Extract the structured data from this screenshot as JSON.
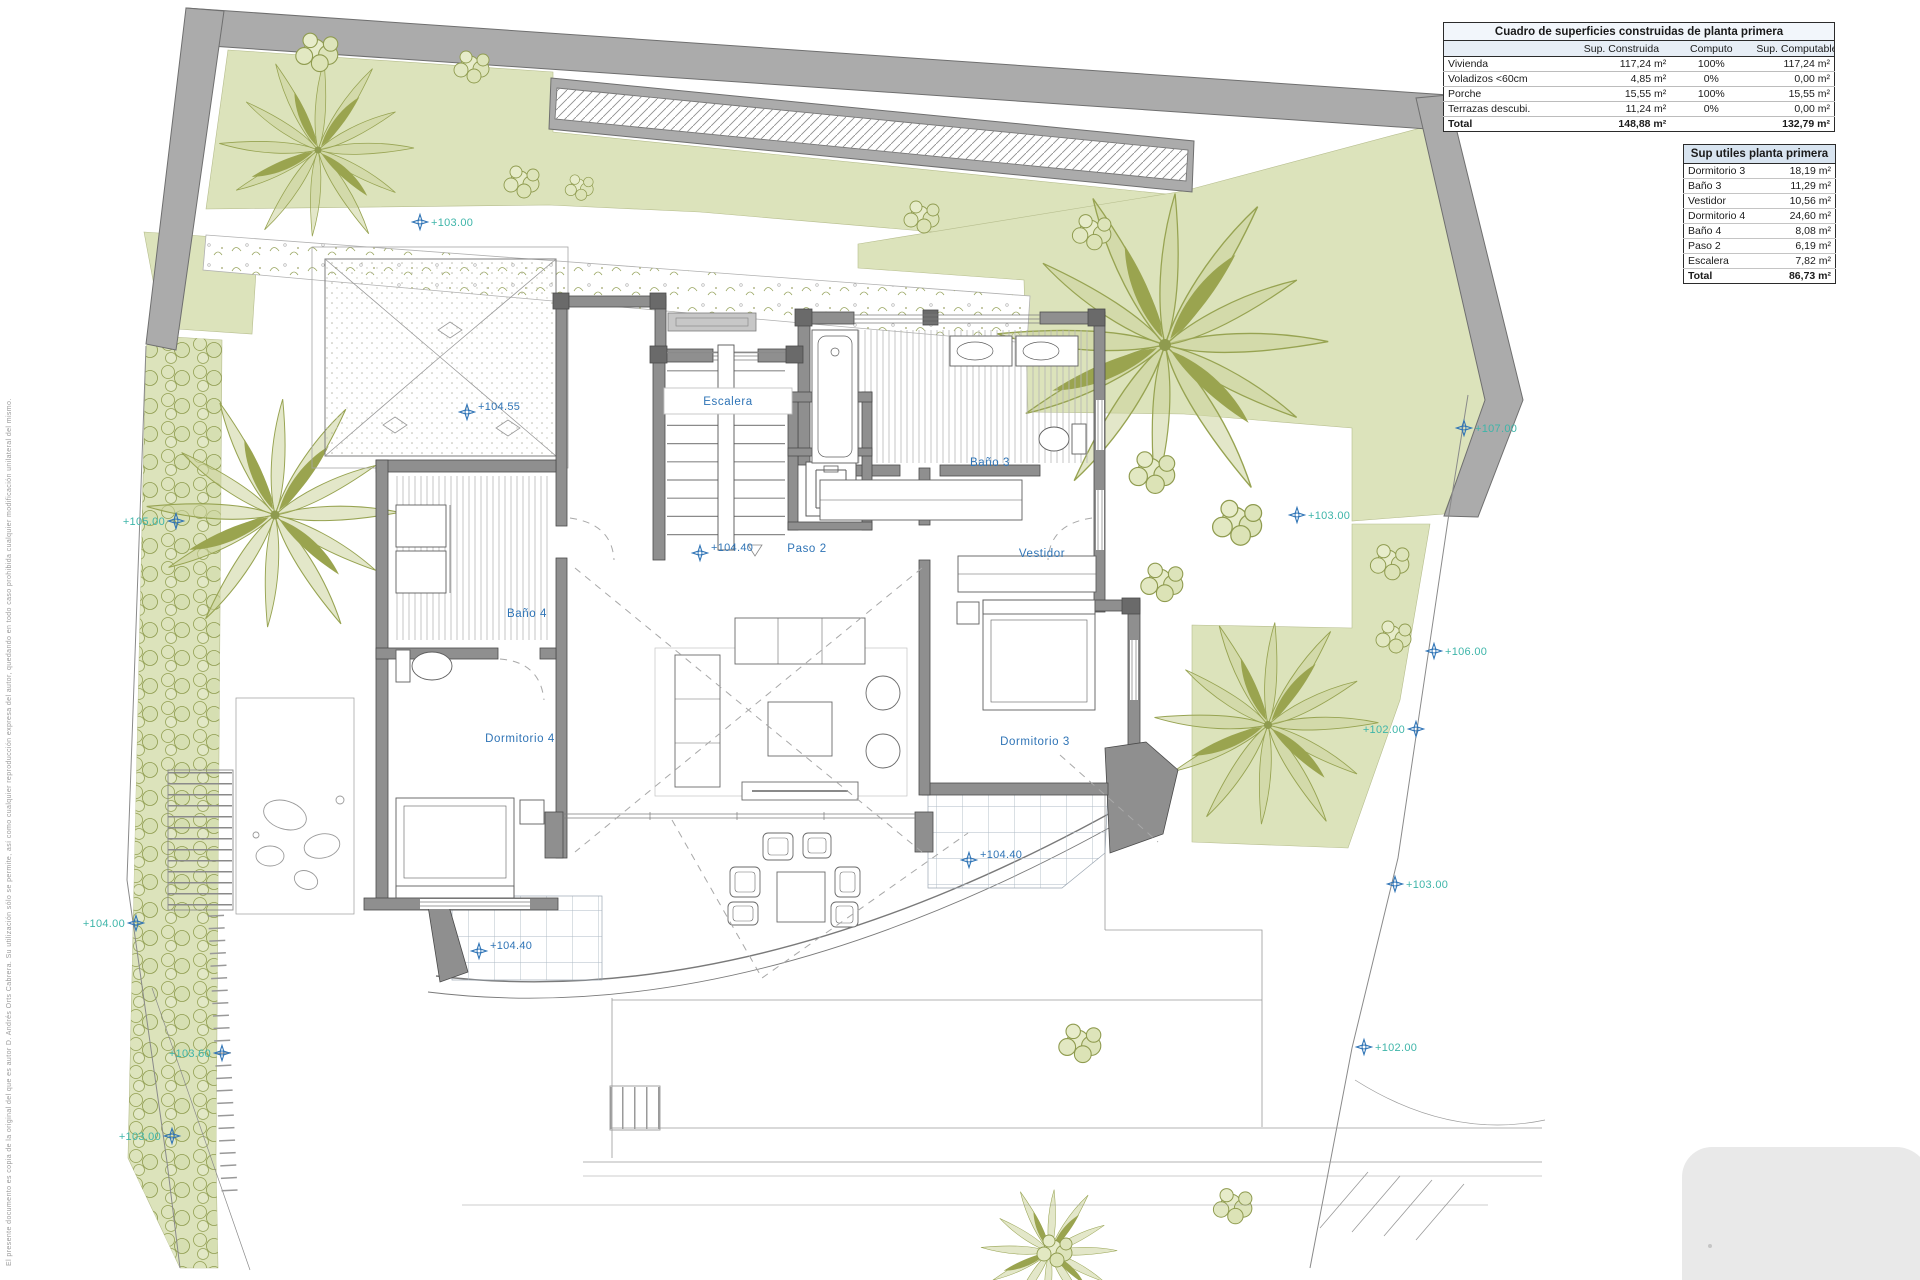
{
  "tables": {
    "construidas": {
      "title": "Cuadro de superficies construidas de planta primera",
      "columns": [
        "",
        "Sup. Construida",
        "Computo",
        "Sup. Computable"
      ],
      "rows": [
        {
          "label": "Vivienda",
          "construida": "117,24 m²",
          "computo": "100%",
          "computable": "117,24 m²"
        },
        {
          "label": "Voladizos <60cm",
          "construida": "4,85 m²",
          "computo": "0%",
          "computable": "0,00 m²"
        },
        {
          "label": "Porche",
          "construida": "15,55 m²",
          "computo": "100%",
          "computable": "15,55 m²"
        },
        {
          "label": "Terrazas descubi.",
          "construida": "11,24 m²",
          "computo": "0%",
          "computable": "0,00 m²"
        }
      ],
      "total": {
        "label": "Total",
        "construida": "148,88 m²",
        "computo": "",
        "computable": "132,79 m²"
      }
    },
    "utiles": {
      "title": "Sup utiles planta primera",
      "rows": [
        {
          "label": "Dormitorio 3",
          "value": "18,19 m²"
        },
        {
          "label": "Baño 3",
          "value": "11,29 m²"
        },
        {
          "label": "Vestidor",
          "value": "10,56 m²"
        },
        {
          "label": "Dormitorio 4",
          "value": "24,60 m²"
        },
        {
          "label": "Baño 4",
          "value": "8,08 m²"
        },
        {
          "label": "Paso 2",
          "value": "6,19 m²"
        },
        {
          "label": "Escalera",
          "value": "7,82 m²"
        }
      ],
      "total": {
        "label": "Total",
        "value": "86,73 m²"
      }
    }
  },
  "plan": {
    "room_labels": [
      {
        "text": "Escalera"
      },
      {
        "text": "Baño 3"
      },
      {
        "text": "Paso 2"
      },
      {
        "text": "Vestidor"
      },
      {
        "text": "Baño 4"
      },
      {
        "text": "Dormitorio 4"
      },
      {
        "text": "Dormitorio 3"
      }
    ],
    "level_markers": [
      {
        "text": "+103.00"
      },
      {
        "text": "+104.55"
      },
      {
        "text": "+107.00"
      },
      {
        "text": "+105.00"
      },
      {
        "text": "+103.00"
      },
      {
        "text": "+104.40"
      },
      {
        "text": "+106.00"
      },
      {
        "text": "+102.00"
      },
      {
        "text": "+104.00"
      },
      {
        "text": "+103.60"
      },
      {
        "text": "+103.00"
      },
      {
        "text": "+102.00"
      },
      {
        "text": "+103.00"
      },
      {
        "text": "+104.40"
      },
      {
        "text": "+104.40"
      }
    ]
  },
  "side_note": "El presente documento es copia de la original del que es autor D. Andrés Orts Cabrera. Su utilización sólo se permite, así como cualquier reproducción expresa del autor, quedando en todo caso prohibida cualquier modificación unilateral del mismo.",
  "colors": {
    "teal": "#3eb5a9",
    "blue": "#2f74b6",
    "garden": "#dce3bb",
    "boundary_wall": "#ababab"
  }
}
